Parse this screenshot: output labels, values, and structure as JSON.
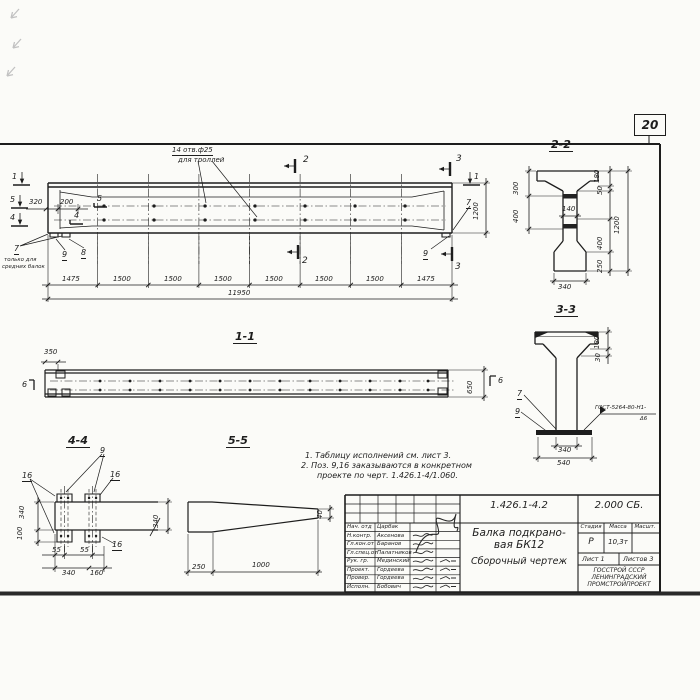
{
  "page": {
    "sheet_number": "20"
  },
  "elevation": {
    "holes_note_1": "14 отв.ф25",
    "holes_note_2": "для троллей",
    "view_mark_1": "1",
    "view_mark_5": "5",
    "view_mark_4": "4",
    "cut_2": "2",
    "cut_3": "3",
    "dim_320": "320",
    "dim_200": "200",
    "pos_4": "4",
    "pos_5": "5",
    "pos_7": "7",
    "pos_8": "8",
    "pos_9": "9",
    "side_note_1": "только для",
    "side_note_2": "средних балок",
    "dim_height": "1200",
    "segments": [
      "1475",
      "1500",
      "1500",
      "1500",
      "1500",
      "1500",
      "1500",
      "1475"
    ],
    "dim_total": "11950"
  },
  "section_1_1": {
    "title": "1-1",
    "dim_350": "350",
    "dim_650": "650",
    "cut_6": "6"
  },
  "section_2_2": {
    "title": "2-2",
    "dim_300": "300",
    "dim_400_left": "400",
    "dim_140": "140",
    "dim_180": "180",
    "dim_50": "50",
    "dim_400_right": "400",
    "dim_250": "250",
    "dim_1200": "1200",
    "dim_340": "340"
  },
  "section_3_3": {
    "title": "3-3",
    "dim_180": "180",
    "dim_30": "30",
    "pos_7": "7",
    "pos_9": "9",
    "weld_line_1": "ГОСТ-5264-80-Н1-",
    "weld_line_2": "Δ6",
    "dim_340": "340",
    "dim_540": "540"
  },
  "section_4_4": {
    "title": "4-4",
    "pos_9": "9",
    "pos_16": "16",
    "dim_340_left": "340",
    "dim_100": "100",
    "dim_55": "55",
    "dim_340_bottom": "340",
    "dim_160": "160",
    "dim_340_right": "340"
  },
  "section_5_5": {
    "title": "5-5",
    "dim_40": "40",
    "dim_250": "250",
    "dim_1000": "1000"
  },
  "notes": {
    "line_1": "1. Таблицу исполнений см. лист 3.",
    "line_2": "2. Поз. 9,16 заказываются в конкретном",
    "line_3": "проекте по черт. 1.426.1-4/1.060."
  },
  "title_block": {
    "doc_number": "1.426.1-4.2",
    "album": "2.000 СБ.",
    "title_line_1": "Балка подкрано-",
    "title_line_2": "вая БК12",
    "title_line_3": "Сборочный  чертеж",
    "col_stage": "Стадия",
    "col_mass": "Масса",
    "col_scale": "Масшт.",
    "stage": "Р",
    "mass": "10,3т",
    "sheet": "Лист 1",
    "sheets": "Листов 3",
    "org_line_1": "ГОССТРОЙ СССР",
    "org_line_2": "ЛЕНИНГРАДСКИЙ",
    "org_line_3": "ПРОМСТРОЙПРОЕКТ",
    "staff": [
      {
        "role": "Нач. отд",
        "name": "Царбак"
      },
      {
        "role": "Н.контр.",
        "name": "Аксенова"
      },
      {
        "role": "Гл.кон.от",
        "name": "Баранов"
      },
      {
        "role": "Гл.спец.от",
        "name": "Палатников"
      },
      {
        "role": "Рук. гр.",
        "name": "Мединский"
      },
      {
        "role": "Проект.",
        "name": "Гордеева"
      },
      {
        "role": "Провер.",
        "name": "Гордеева"
      },
      {
        "role": "Исполн.",
        "name": "Бобович"
      }
    ]
  }
}
